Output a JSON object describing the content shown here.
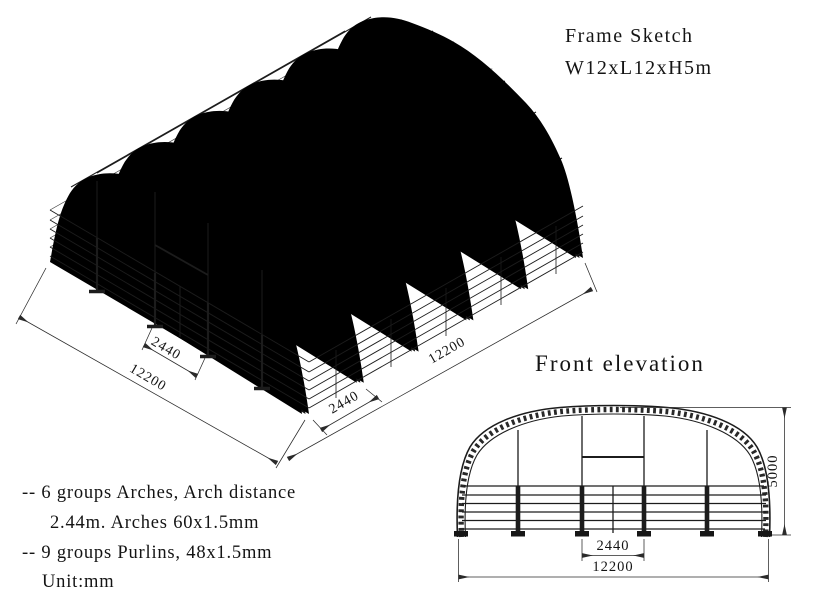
{
  "header": {
    "title_line1": "Frame Sketch",
    "title_line2": "W12xL12xH5m"
  },
  "isometric_view": {
    "dim_arch_bay_left": "2440",
    "dim_total_left": "12200",
    "dim_arch_bay_right": "2440",
    "dim_total_right": "12200"
  },
  "front_elevation": {
    "title": "Front elevation",
    "dim_center_bay": "2440",
    "dim_total_width": "12200",
    "dim_height": "5000"
  },
  "notes": {
    "line1": "-- 6 groups Arches, Arch distance",
    "line2": "2.44m. Arches 60x1.5mm",
    "line3": "-- 9 groups Purlins, 48x1.5mm",
    "line4": "Unit:mm"
  },
  "colors": {
    "line": "#1c1c1c",
    "background": "#ffffff"
  }
}
